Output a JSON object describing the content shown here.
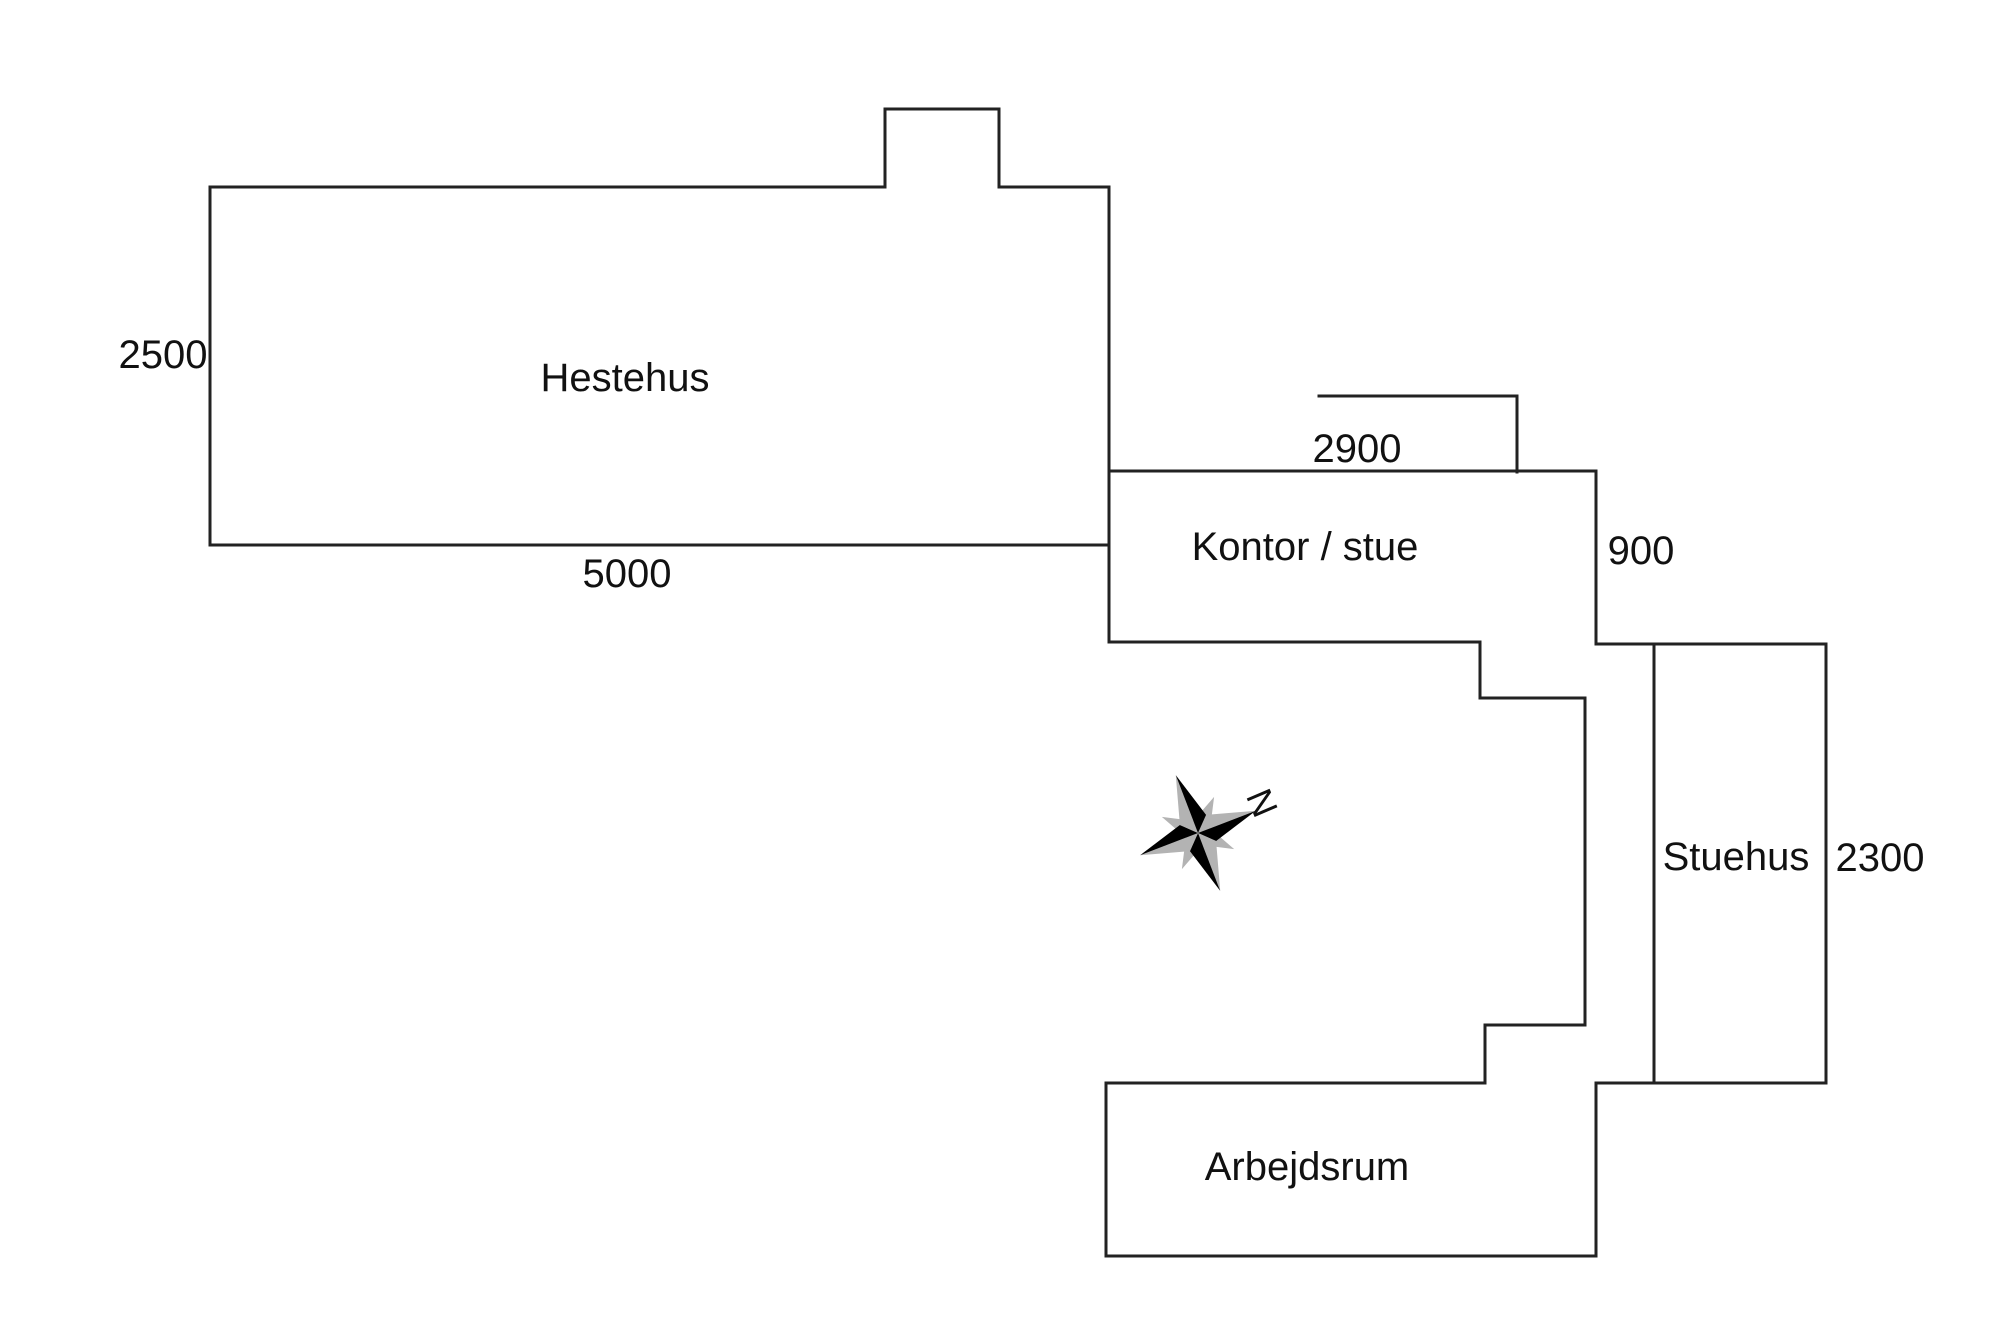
{
  "page": {
    "background": "#ffffff",
    "type": "floor-plan-sketch"
  },
  "floorplan": {
    "style": {
      "line_color": "#222222",
      "line_width": 3,
      "text_color": "#111111",
      "compass_black": "#000000",
      "compass_gray": "#b3b3b3"
    },
    "rooms": [
      {
        "name": "Hestehus",
        "width_label": "5000",
        "height_label": "2500"
      },
      {
        "name": "Kontor / stue",
        "width_label": "2900",
        "height_label": "900"
      },
      {
        "name": "Stuehus",
        "height_label": "2300"
      },
      {
        "name": "Arbejdsrum"
      }
    ],
    "labels": {
      "hestehus": {
        "text": "Hestehus",
        "x": 625,
        "y": 378
      },
      "kontor_stue": {
        "text": "Kontor / stue",
        "x": 1305,
        "y": 547
      },
      "stuehus": {
        "text": "Stuehus",
        "x": 1736,
        "y": 857
      },
      "arbejdsrum": {
        "text": "Arbejdsrum",
        "x": 1307,
        "y": 1167
      },
      "dim_2500": {
        "text": "2500",
        "x": 163,
        "y": 355
      },
      "dim_5000": {
        "text": "5000",
        "x": 627,
        "y": 574
      },
      "dim_2900": {
        "text": "2900",
        "x": 1357,
        "y": 449
      },
      "dim_900": {
        "text": "900",
        "x": 1641,
        "y": 551
      },
      "dim_2300": {
        "text": "2300",
        "x": 1880,
        "y": 858
      },
      "north": {
        "text": "N",
        "x": 1262,
        "y": 803,
        "rot": 67,
        "size": 36
      }
    },
    "walls": {
      "segments": [
        [
          210,
          187,
          885,
          187
        ],
        [
          885,
          187,
          885,
          109
        ],
        [
          885,
          109,
          999,
          109
        ],
        [
          999,
          109,
          999,
          187
        ],
        [
          999,
          187,
          1109,
          187
        ],
        [
          210,
          187,
          210,
          545
        ],
        [
          210,
          545,
          1109,
          545
        ],
        [
          1109,
          187,
          1109,
          642
        ],
        [
          1109,
          471,
          1596,
          471
        ],
        [
          1596,
          471,
          1596,
          644
        ],
        [
          1109,
          642,
          1480,
          642
        ],
        [
          1480,
          642,
          1480,
          698
        ],
        [
          1480,
          698,
          1585,
          698
        ],
        [
          1585,
          698,
          1585,
          1025
        ],
        [
          1585,
          1025,
          1485,
          1025
        ],
        [
          1485,
          1025,
          1485,
          1083
        ],
        [
          1485,
          1083,
          1106,
          1083
        ],
        [
          1106,
          1083,
          1106,
          1256
        ],
        [
          1106,
          1256,
          1596,
          1256
        ],
        [
          1596,
          1256,
          1596,
          1083
        ],
        [
          1596,
          1083,
          1825,
          1083
        ],
        [
          1596,
          644,
          1826,
          644
        ],
        [
          1654,
          644,
          1654,
          1083
        ],
        [
          1826,
          644,
          1826,
          1083
        ]
      ]
    },
    "dimension_lines": {
      "segments": [
        [
          1319,
          396,
          1517,
          396
        ],
        [
          1517,
          396,
          1517,
          472
        ]
      ]
    },
    "compass": {
      "cx": 1198,
      "cy": 833,
      "rotation_deg": 69,
      "arm_length": 62,
      "arm_halfwidth": 14,
      "secondary_tip": 28,
      "secondary_waist": 13
    }
  }
}
